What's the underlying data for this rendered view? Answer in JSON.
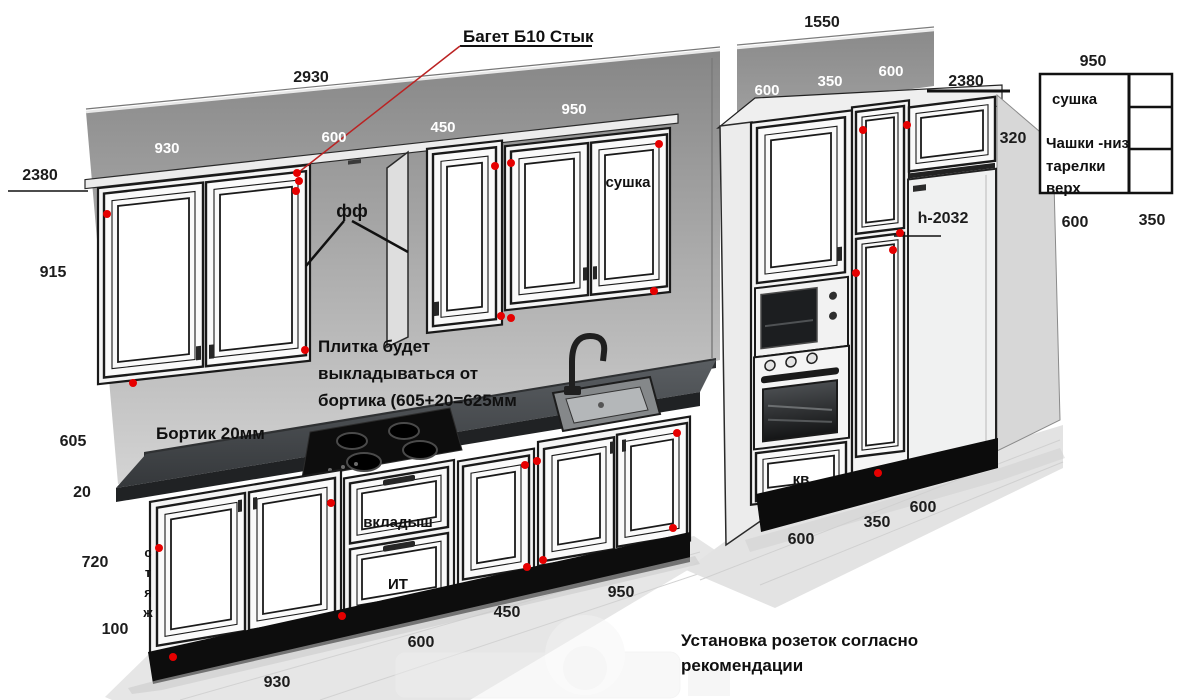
{
  "dimensions": {
    "wall_left_total": "2930",
    "wall_right_total": "1550",
    "height_left": "2380",
    "height_right": "2380",
    "upper_cabinet_height": "915",
    "backsplash_height": "605",
    "bortik_height": "20",
    "base_cabinet_height": "720",
    "plinth_height": "100",
    "fridge_top_cabinet_height": "320",
    "fridge_height": "h-2032",
    "upper_w_930": "930",
    "upper_w_600": "600",
    "upper_w_450": "450",
    "upper_w_950": "950",
    "band_w_600a": "600",
    "band_w_350": "350",
    "band_w_600b": "600",
    "base_w_930": "930",
    "base_w_600": "600",
    "base_w_450": "450",
    "base_w_950": "950",
    "tall_w_600a": "600",
    "tall_w_350": "350",
    "tall_w_600b": "600"
  },
  "annotations": {
    "baget": "Багет Б10 Стык",
    "ff": "фф",
    "tile_note_lines": [
      "Плитка будет",
      "выкладываться от",
      "бортика (605+20=625мм"
    ],
    "bortik": "Бортик 20мм",
    "sockets_lines": [
      "Установка розеток согласно",
      "рекомендации"
    ],
    "styazh_letters": [
      "с",
      "т",
      "я",
      "ж"
    ]
  },
  "cabinet_labels": {
    "sushka_door": "сушка",
    "vkladysh": "вкладыш",
    "it": "ИТ",
    "kv": "кв"
  },
  "legend_table": {
    "width_dim": "950",
    "row1": "сушка",
    "row2_lines": [
      "Чашки -низ",
      "тарелки",
      "верх"
    ],
    "bottom_left_dim": "600",
    "bottom_right_dim": "350"
  },
  "colors": {
    "red_dot": "#e60000",
    "leader_red": "#bb2222",
    "wall_gray": "#8c8c8c",
    "counter_dark": "#3a3d40",
    "cabinet_white": "#fafafa",
    "frame_black": "#1a1a1a"
  }
}
